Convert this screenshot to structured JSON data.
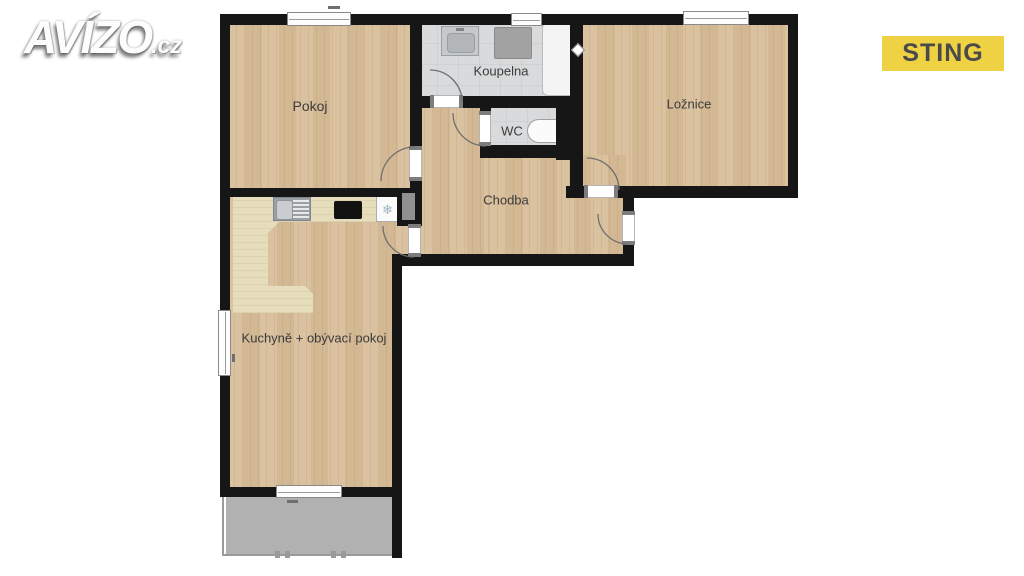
{
  "branding": {
    "logo_text": "AVÍZO",
    "logo_suffix": ".cz",
    "agency_badge": "STING",
    "badge_bg_color": "#efd243",
    "badge_text_color": "#4a4a4a",
    "logo_color": "#fdfdfd"
  },
  "floorplan": {
    "wall_color": "#161616",
    "wood_floor_color": "#d8bd99",
    "tile_floor_color": "#d9dadb",
    "counter_color": "#e6ddbd",
    "balcony_floor_color": "#b1b1b1",
    "rooms": [
      {
        "id": "pokoj",
        "label": "Pokoj"
      },
      {
        "id": "koupelna",
        "label": "Koupelna"
      },
      {
        "id": "wc",
        "label": "WC"
      },
      {
        "id": "loznice",
        "label": "Ložnice"
      },
      {
        "id": "chodba",
        "label": "Chodba"
      },
      {
        "id": "kuchyne",
        "label": "Kuchyně + obývací pokoj"
      }
    ],
    "icons": {
      "snowflake": "❄"
    }
  }
}
